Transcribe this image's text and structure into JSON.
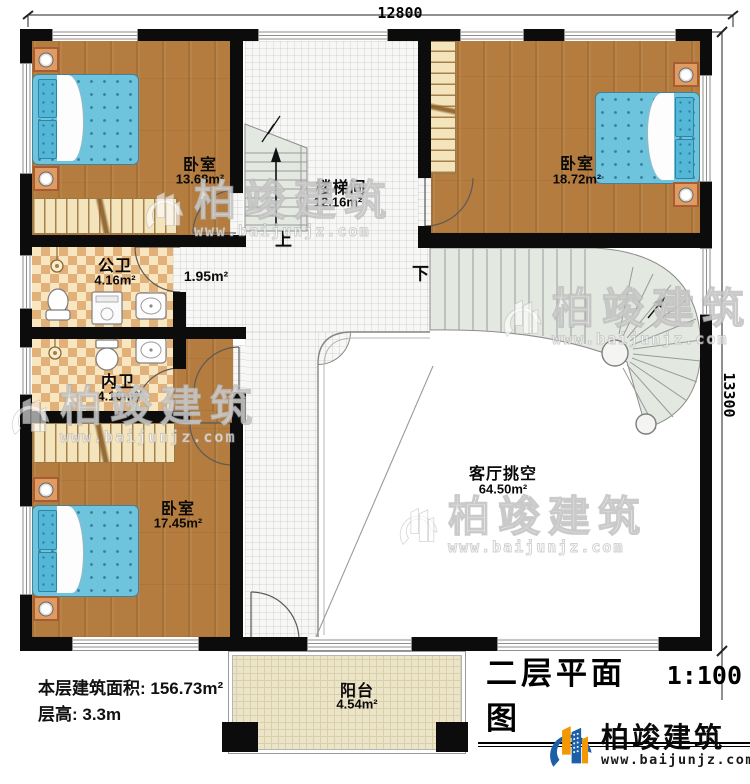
{
  "dimensions": {
    "top": "12800",
    "right": "13300"
  },
  "rooms": {
    "bedroom_tl": {
      "name": "卧室",
      "area": "13.68m²"
    },
    "stairwell": {
      "name": "楼梯间",
      "area": "12.16m²"
    },
    "bedroom_tr": {
      "name": "卧室",
      "area": "18.72m²"
    },
    "public_bath": {
      "name": "公卫",
      "area": "4.16m²"
    },
    "corridor": {
      "area": "1.95m²"
    },
    "private_bath": {
      "name": "内卫",
      "area": "4.16m²"
    },
    "bedroom_bl": {
      "name": "卧室",
      "area": "17.45m²"
    },
    "living_void": {
      "name": "客厅挑空",
      "area": "64.50m²"
    },
    "balcony": {
      "name": "阳台",
      "area": "4.54m²"
    }
  },
  "stairs": {
    "up": "上",
    "down": "下"
  },
  "info": {
    "floor_area": "本层建筑面积: 156.73m²",
    "floor_height": "层高: 3.3m"
  },
  "titleblock": {
    "title": "二层平面图",
    "scale": "1:100"
  },
  "brand": {
    "name": "柏竣建筑",
    "url": "www.baijunjz.com"
  },
  "watermark": {
    "text": "柏竣建筑",
    "url": "www.baijunjz.com"
  },
  "colors": {
    "wall": "#0c0c0c",
    "wood_floor": "#b47c3e",
    "bath_tile": "#e2b079",
    "bed_blue": "#6fc4dd",
    "stair_tread": "#e3e8e1",
    "brand_blue": "#1b5fa8",
    "brand_orange": "#f39800"
  }
}
